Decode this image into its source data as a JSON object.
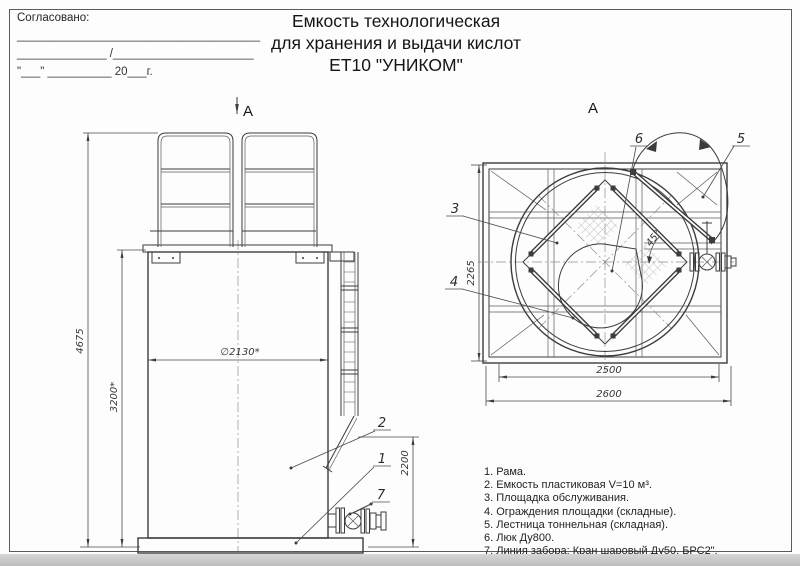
{
  "approval": {
    "label": "Согласовано:",
    "line1": "______________________________________",
    "line2": "______________ /______________________",
    "line3": "\"___\" __________ 20___г."
  },
  "title": {
    "line1": "Емкость технологическая",
    "line2": "для хранения и выдачи кислот",
    "line3": "ЕТ10 \"УНИКОМ\""
  },
  "front_view": {
    "section_label": "А",
    "dims": {
      "total_height": "4675",
      "body_height": "3200*",
      "diameter": "∅2130*",
      "lower_height": "2200"
    },
    "callouts": {
      "c1": "1",
      "c2": "2",
      "c7": "7"
    }
  },
  "top_view": {
    "view_label": "А",
    "dims": {
      "depth": "2265",
      "inner_width": "2500",
      "outer_width": "2600",
      "angle": "45°"
    },
    "callouts": {
      "c3": "3",
      "c4": "4",
      "c5": "5",
      "c6": "6"
    }
  },
  "parts_list": {
    "items": [
      "1. Рама.",
      "2. Емкость пластиковая V=10 м³.",
      "3. Площадка обслуживания.",
      "4. Ограждения площадки (складные).",
      "5. Лестница тоннельная (складная).",
      "6. Люк Ду800.",
      "7. Линия забора: Кран шаровый Ду50, БРС2\"."
    ]
  }
}
